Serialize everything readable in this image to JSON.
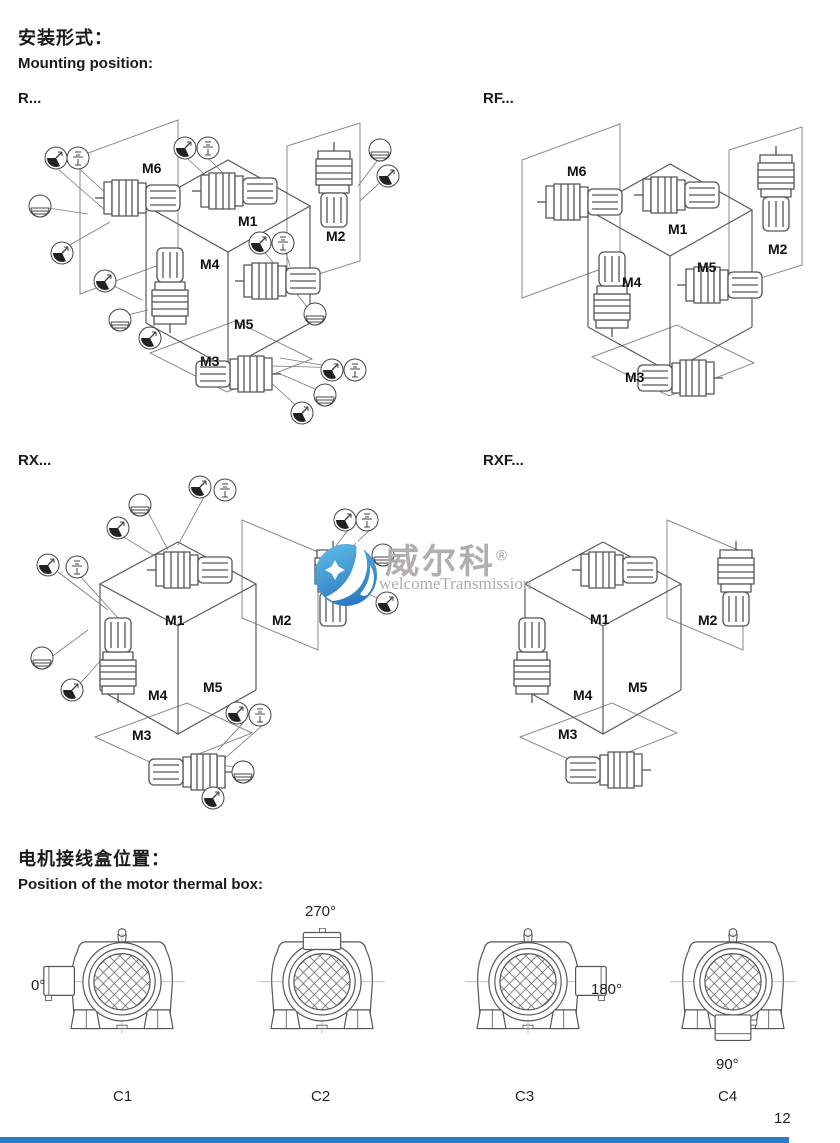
{
  "page": {
    "title_cn": "安装形式：",
    "title_en": "Mounting position:",
    "section2_cn": "电机接线盒位置：",
    "section2_en": "Position of the motor thermal box:",
    "page_number": "12"
  },
  "mounting": {
    "r": {
      "label": "R...",
      "m1": "M1",
      "m2": "M2",
      "m3": "M3",
      "m4": "M4",
      "m5": "M5",
      "m6": "M6"
    },
    "rf": {
      "label": "RF...",
      "m1": "M1",
      "m2": "M2",
      "m3": "M3",
      "m4": "M4",
      "m5": "M5",
      "m6": "M6"
    },
    "rx": {
      "label": "RX...",
      "m1": "M1",
      "m2": "M2",
      "m3": "M3",
      "m4": "M4",
      "m5": "M5"
    },
    "rxf": {
      "label": "RXF...",
      "m1": "M1",
      "m2": "M2",
      "m3": "M3",
      "m4": "M4",
      "m5": "M5"
    }
  },
  "watermark": {
    "brand": "威尔科",
    "registered": "®",
    "subtitle": "welcomeTransmission",
    "logo_blue_top": "#62bde8",
    "logo_blue_bottom": "#2e7cc0",
    "text_gray": "#b3aeab"
  },
  "thermal_box": {
    "variants": [
      {
        "label": "C1",
        "angle": "0°",
        "box_position": "left"
      },
      {
        "label": "C2",
        "angle": "270°",
        "box_position": "top"
      },
      {
        "label": "C3",
        "angle": "180°",
        "box_position": "right"
      },
      {
        "label": "C4",
        "angle": "90°",
        "box_position": "bottom"
      }
    ]
  },
  "footer": {
    "bar_color": "#2d7cc9"
  }
}
